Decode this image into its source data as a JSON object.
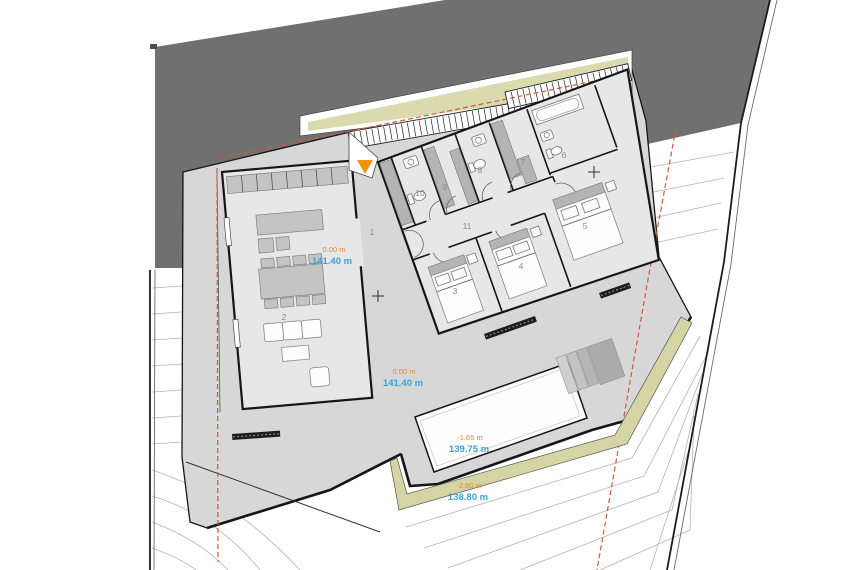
{
  "drawing": {
    "type": "architectural-site-plan",
    "rooms": [
      {
        "id": "1",
        "label": "1"
      },
      {
        "id": "2",
        "label": "2"
      },
      {
        "id": "3",
        "label": "3"
      },
      {
        "id": "4",
        "label": "4"
      },
      {
        "id": "5",
        "label": "5"
      },
      {
        "id": "6",
        "label": "6"
      },
      {
        "id": "7",
        "label": "7"
      },
      {
        "id": "8",
        "label": "8"
      },
      {
        "id": "9",
        "label": "9"
      },
      {
        "id": "10",
        "label": "10"
      },
      {
        "id": "11",
        "label": "11"
      }
    ],
    "levels": [
      {
        "delta": "0.00 m",
        "abs": "141.40 m"
      },
      {
        "delta": "0.00 m",
        "abs": "141.40 m"
      },
      {
        "delta": "-1.65 m",
        "abs": "139.75 m"
      },
      {
        "delta": "-2.60 m",
        "abs": "138.80 m"
      }
    ],
    "colors": {
      "road": "#707070",
      "terrace": "#d7d7d7",
      "room": "#e7e7e7",
      "wardrobe": "#b4b4b4",
      "furniture": "#c4c4c4",
      "beige": "#dadaae",
      "beige2": "#d4d4a4",
      "orange": "#f2930d",
      "lvl-orange": "#e08a2a",
      "lvl-blue": "#3aa3d9",
      "red": "#cd5844",
      "contour": "#b3b3b3",
      "wall": "#161616"
    },
    "icons": {
      "entrance_marker": "orange-triangle-entrance-arrow"
    }
  }
}
